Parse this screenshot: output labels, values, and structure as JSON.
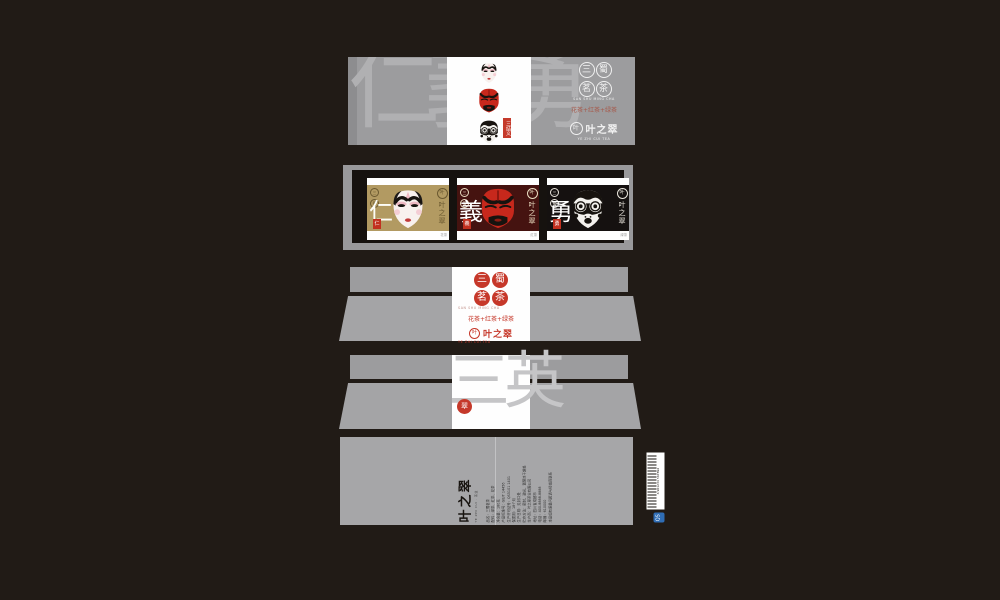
{
  "colors": {
    "background": "#211b16",
    "panel_gray": "#9c9c9e",
    "accent_red": "#c6382a",
    "card_gold": "#b29a62",
    "card_dark_red": "#451310",
    "card_black": "#151110"
  },
  "brand": {
    "name": "叶之翠",
    "name_latin": "YE ZHI CUI TEA",
    "logo_glyph": "叶",
    "product_seal_chars": [
      "三",
      "蜀",
      "茗",
      "茶"
    ],
    "product_latin": "SAN SHU MING CHA",
    "tea_line": "花茶+红茶+绿茶"
  },
  "sleeve": {
    "watermark": "仁義勇",
    "tag": "三结义"
  },
  "tray": {
    "cards": [
      {
        "virtue": "仁",
        "mini_seals": [
          "三",
          "蜀"
        ],
        "seal": "仁",
        "note": "花茶",
        "brand_vertical": "叶之翠"
      },
      {
        "virtue": "義",
        "mini_seals": [
          "三",
          "蜀"
        ],
        "seal": "義",
        "note": "红茶",
        "brand_vertical": "叶之翠"
      },
      {
        "virtue": "勇",
        "mini_seals": [
          "三",
          "蜀"
        ],
        "seal": "勇",
        "note": "绿茶",
        "brand_vertical": "叶之翠"
      }
    ]
  },
  "lid_back": {
    "watermark": "三英",
    "seal_glyph": "翠"
  },
  "bottom": {
    "brand": "叶之翠",
    "brand_sub": "YE ZHI CUI · 茶业",
    "info_text": "品名：三蜀茗茶\n配料：绿茶、红茶、花茶\n净含量：180克\n产品标准号：GB/T 14456\n生产许可证号：QS5101 1401\n保质期：18个月\n生产日期：见封口处\n贮存方法：密封、避光、置阴凉干燥处\n生产商：叶之翠茶业有限公司\n地址：四川省成都市\n电话：400-8888-8888\n邮编：610000\n本品如有质量问题请与经销商联系",
    "barcode_number": "6 901234 567892",
    "qs_label": "QS"
  }
}
